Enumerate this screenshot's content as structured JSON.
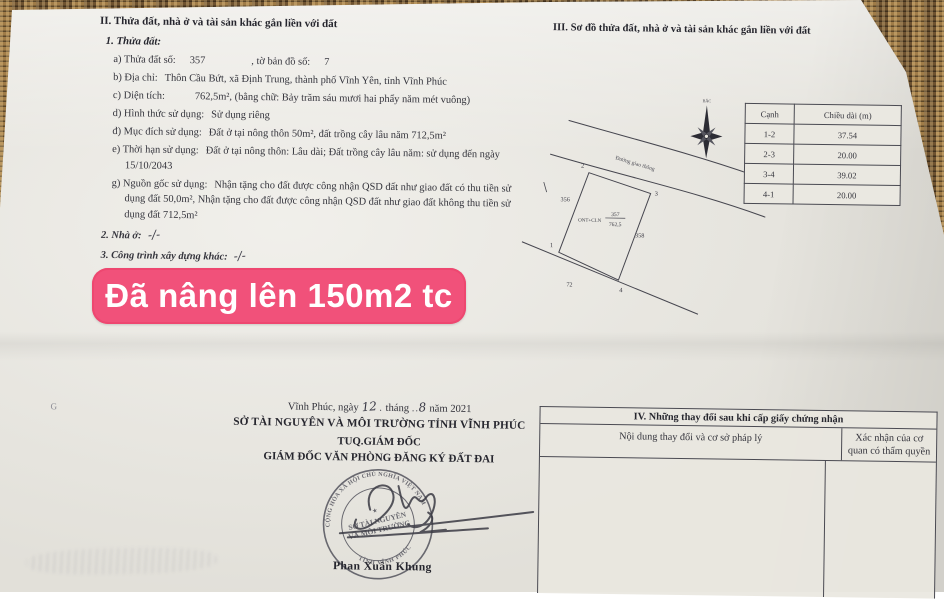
{
  "overlay_badge": {
    "text": "Đã nâng lên 150m2 tc",
    "bg_color": "#f1517a",
    "text_color": "#ffffff"
  },
  "section_ii": {
    "title": "II. Thửa đất, nhà ở và tài sản khác gắn liền với đất",
    "parcel_heading": "1. Thửa đất:",
    "fields": [
      {
        "label": "a) Thửa đất số:",
        "value": "357",
        "label2": ", tờ bản đồ số:",
        "value2": "7"
      },
      {
        "label": "b) Địa chỉ:",
        "value": "Thôn Cầu Bứt, xã Định Trung, thành phố Vĩnh Yên, tỉnh Vĩnh Phúc"
      },
      {
        "label": "c) Diện tích:",
        "value": "762,5m², (bằng chữ: Bảy trăm sáu mươi hai phẩy năm mét vuông)"
      },
      {
        "label": "d) Hình thức sử dụng:",
        "value": "Sử dụng riêng"
      },
      {
        "label": "đ) Mục đích sử dụng:",
        "value": "Đất ở tại nông thôn 50m², đất trồng cây lâu năm 712,5m²"
      },
      {
        "label": "e) Thời hạn sử dụng:",
        "value": "Đất ở tại nông thôn: Lâu dài; Đất trồng cây lâu năm: sử dụng đến ngày 15/10/2043"
      },
      {
        "label": "g) Nguồn gốc sử dụng:",
        "value": "Nhận tặng cho đất được công nhận QSD đất như giao đất có thu tiền sử dụng đất 50,0m², Nhận tặng cho đất được công nhận QSD đất như giao đất không thu tiền sử dụng đất 712,5m²"
      }
    ],
    "other_items": [
      {
        "label": "2. Nhà ở:",
        "value": "-/-"
      },
      {
        "label": "3. Công trình xây dựng khác:",
        "value": "-/-"
      },
      {
        "label": "4. Rừng sản xuất là rừng trồng:",
        "value": "-/-"
      },
      {
        "label": "5. Cây lâu năm:",
        "value": "-/-"
      },
      {
        "label": "6. Ghi chú:",
        "value": "Không"
      }
    ]
  },
  "section_iii": {
    "title": "III. Sơ đồ thửa đất, nhà ở và tài sản khác gắn liền với đất",
    "edge_table": {
      "headers": [
        "Cạnh",
        "Chiều dài (m)"
      ],
      "rows": [
        [
          "1-2",
          "37.54"
        ],
        [
          "2-3",
          "20.00"
        ],
        [
          "3-4",
          "39.02"
        ],
        [
          "4-1",
          "20.00"
        ]
      ]
    },
    "diagram": {
      "compass_label": "BẮC",
      "road_label": "Đường giao thông",
      "land_use_code": "ONT+CLN",
      "parcel_number": "357",
      "parcel_area": "762,5",
      "vertex_1": "1",
      "vertex_2": "2",
      "vertex_3": "3",
      "vertex_4": "4",
      "neighbor_left": "356",
      "neighbor_right": "358",
      "neighbor_bottom": "72"
    }
  },
  "section_iv": {
    "title": "IV. Những thay đổi sau khi cấp giấy chứng nhận",
    "col_left": "Nội dung thay đổi và cơ sở pháp lý",
    "col_right": "Xác nhận của cơ quan có thẩm quyền"
  },
  "signature_block": {
    "date_prefix": "Vĩnh Phúc, ngày",
    "day": "12",
    "month_label": "tháng",
    "month": "8",
    "year_label": "năm 2021",
    "agency": "SỞ TÀI NGUYÊN VÀ MÔI TRƯỜNG TỈNH VĨNH PHÚC",
    "deputy_line": "TUQ.GIÁM ĐỐC",
    "role_line": "GIÁM ĐỐC VĂN PHÒNG ĐĂNG KÝ ĐẤT ĐAI",
    "signer_name": "Phan Xuân Khung",
    "stamp": {
      "ring_top": "CỘNG HÒA XÃ HỘI CHỦ NGHĨA VIỆT NAM",
      "center_line1": "SỞ TÀI NGUYÊN",
      "center_line2": "VÀ MÔI TRƯỜNG",
      "ring_bottom": "TỈNH VĨNH PHÚC"
    }
  }
}
